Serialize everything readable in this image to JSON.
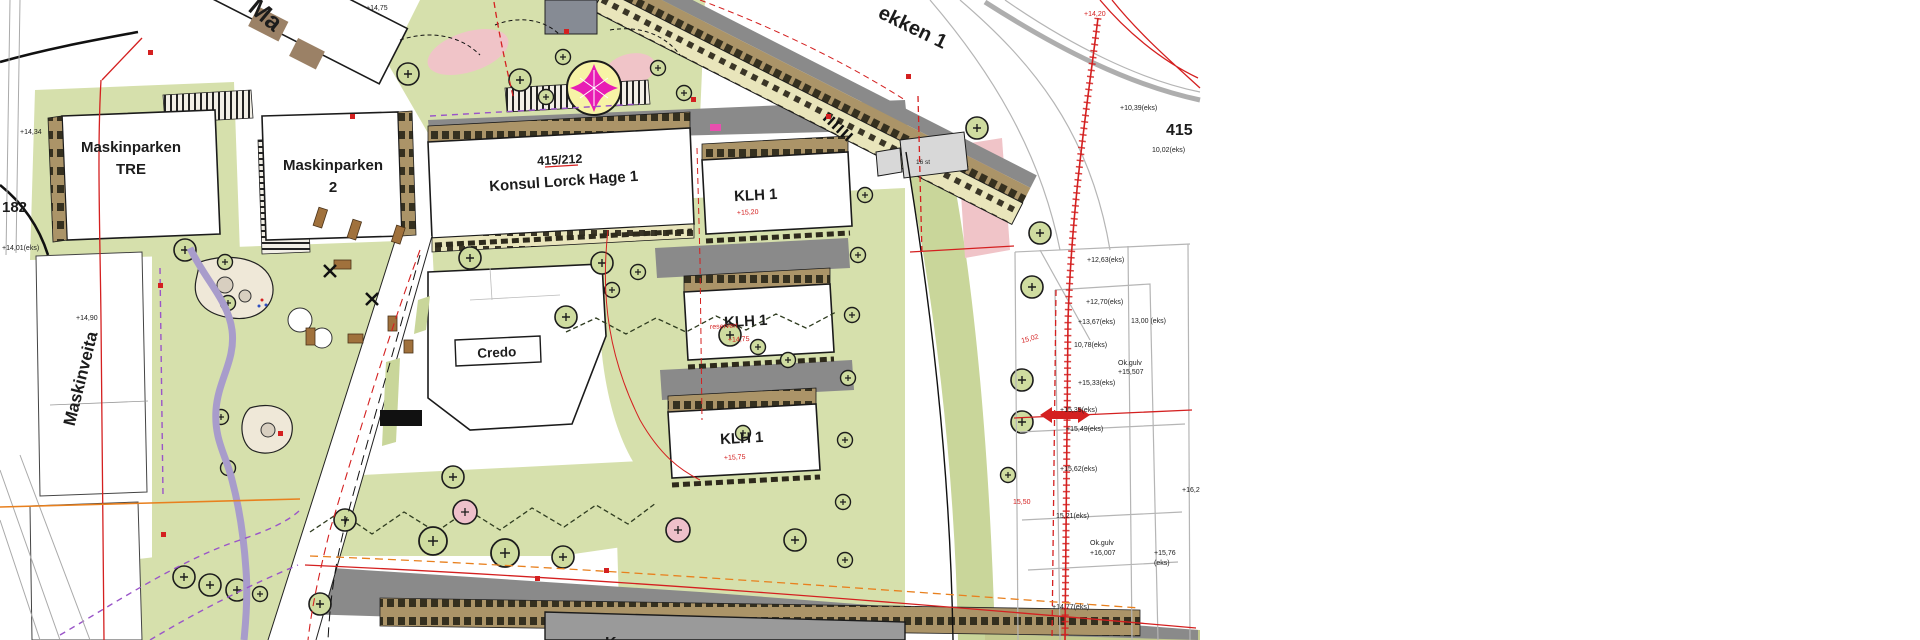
{
  "title": "Site plan – Maskinparken / Konsul Lorck Hage area",
  "labels": {
    "maskinparken_tre_1": "Maskinparken",
    "maskinparken_tre_2": "TRE",
    "maskinparken_2_1": "Maskinparken",
    "maskinparken_2_2": "2",
    "parcel_415_212": "415/212",
    "konsul_lorck_hage": "Konsul Lorck Hage 1",
    "klh": "KLH 1",
    "credo": "Credo",
    "maskinveita": "Maskinveita",
    "parcel_182": "182",
    "parcel_415": "415",
    "street_partial": "ekken 1",
    "building_partial_top": "Ma",
    "building_partial_bottom": "K",
    "parking_count": "16 st"
  },
  "elev_black": [
    "+14,75",
    "+14,34",
    "+14,01(eks)",
    "+14,90",
    "+10,39(eks)",
    "10,02(eks)",
    "+12,63(eks)",
    "+12,70(eks)",
    "+13,67(eks)",
    "13,00 (eks)",
    "10,78(eks)",
    "Ok.gulv",
    "+15,507",
    "+15,33(eks)",
    "+15,39(eks)",
    "+15,49(eks)",
    "+15,62(eks)",
    "15,21(eks)",
    "Ok.gulv",
    "+16,007",
    "+15,76",
    "(eks)",
    "+14,77(eks)",
    "+16,2"
  ],
  "elev_red": [
    "+15,20",
    "+14,75",
    "+15,75",
    "15,02",
    "15,50",
    "+14,20",
    "reservert"
  ],
  "colors": {
    "green_area": "#d6e0ac",
    "green_verge": "#c9d69a",
    "building_band": "#ab9468",
    "cream_band": "#e9e5bb",
    "road_grey": "#8a8a8a",
    "boundary_red": "#d42020",
    "path_purple": "#a89ccb",
    "violet_dash": "#9a55c8",
    "feature_magenta": "#e81cb4",
    "feature_yellow": "#f7f3a6",
    "pink_area": "#f0c4c8",
    "orange_line": "#e8801e",
    "sand": "#efe8d8"
  }
}
